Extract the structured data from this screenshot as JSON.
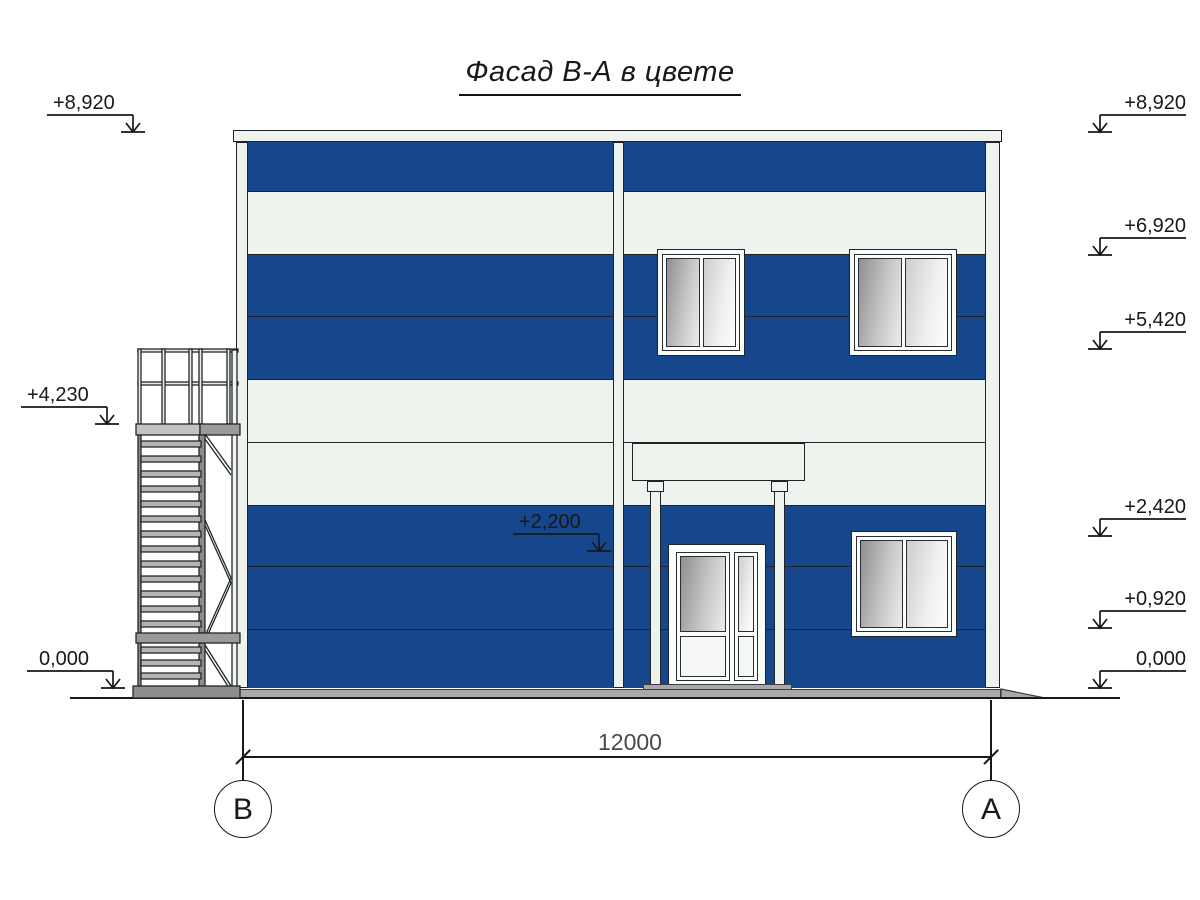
{
  "title": {
    "text": "Фасад В-А в цвете"
  },
  "colors": {
    "facade_blue": "#16478c",
    "panel_white": "#eff3ee",
    "outline": "#20242a",
    "concrete_gray": "#a9a9a9",
    "dim_text_gray": "#4a4a4a"
  },
  "elevation_markers": {
    "left": [
      {
        "label": "+8,920"
      },
      {
        "label": "+4,230"
      },
      {
        "label": "0,000"
      }
    ],
    "middle": [
      {
        "label": "+2,200"
      }
    ],
    "right": [
      {
        "label": "+8,920"
      },
      {
        "label": "+6,920"
      },
      {
        "label": "+5,420"
      },
      {
        "label": "+2,420"
      },
      {
        "label": "+0,920"
      },
      {
        "label": "0,000"
      }
    ]
  },
  "dimension": {
    "value": "12000"
  },
  "axes": {
    "left": "В",
    "right": "А"
  }
}
